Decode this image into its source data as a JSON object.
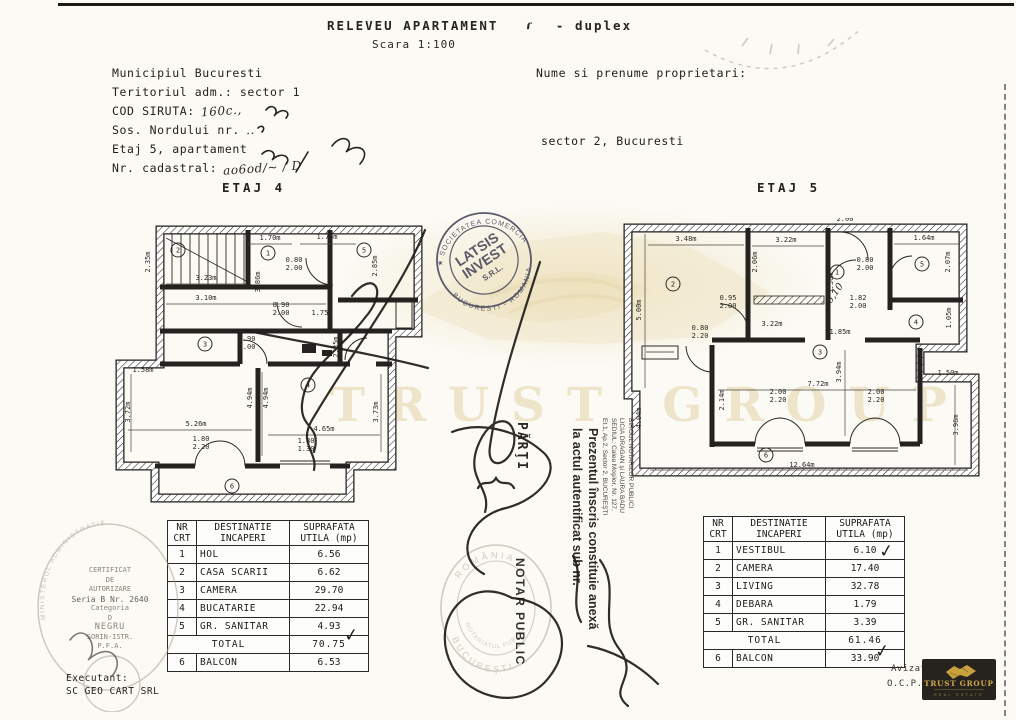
{
  "header": {
    "title": "RELEVEU APARTAMENT",
    "hand_mark": "ɾ",
    "suffix": "- duplex",
    "scale": "Scara 1:100",
    "left_lines": [
      {
        "label": "Municipiul Bucuresti",
        "hand": ""
      },
      {
        "label": "Teritoriul adm.: sector 1",
        "hand": ""
      },
      {
        "label": "COD SIRUTA:",
        "hand": "160c.,"
      },
      {
        "label": "Sos. Nordului nr.",
        "hand": ".."
      },
      {
        "label": "Etaj 5, apartament",
        "hand": ""
      },
      {
        "label": "Nr. cadastral:",
        "hand": "ao6od/~  / D"
      }
    ],
    "owner_label": "Nume si prenume proprietari:",
    "owner_city": "sector 2, Bucuresti"
  },
  "plans": {
    "etaj4": {
      "title": "ETAJ 4",
      "labels": [
        {
          "t": "1.70m",
          "x": 270,
          "y": 240
        },
        {
          "t": "1.76m",
          "x": 327,
          "y": 239
        },
        {
          "t": "2.35m",
          "x": 150,
          "y": 262,
          "r": -90
        },
        {
          "t": "3.23m",
          "x": 206,
          "y": 280
        },
        {
          "t": "3.10m",
          "x": 206,
          "y": 300
        },
        {
          "t": "3.86m",
          "x": 260,
          "y": 282,
          "r": -90
        },
        {
          "t": "0.80",
          "x": 294,
          "y": 262
        },
        {
          "t": "2.00",
          "x": 294,
          "y": 270
        },
        {
          "t": "2.85m",
          "x": 377,
          "y": 266,
          "r": -90
        },
        {
          "t": "1.75m",
          "x": 322,
          "y": 315
        },
        {
          "t": "0.90",
          "x": 281,
          "y": 307
        },
        {
          "t": "2.00",
          "x": 281,
          "y": 315
        },
        {
          "t": "0.90",
          "x": 247,
          "y": 341
        },
        {
          "t": "2.00",
          "x": 247,
          "y": 349
        },
        {
          "t": "2.35m",
          "x": 338,
          "y": 347,
          "r": -90
        },
        {
          "t": "1.58m",
          "x": 143,
          "y": 372
        },
        {
          "t": "5.26m",
          "x": 196,
          "y": 426
        },
        {
          "t": "4.65m",
          "x": 324,
          "y": 431
        },
        {
          "t": "4.94m",
          "x": 252,
          "y": 398,
          "r": -90
        },
        {
          "t": "4.94m",
          "x": 268,
          "y": 398,
          "r": -90
        },
        {
          "t": "3.72m",
          "x": 130,
          "y": 412,
          "r": -90
        },
        {
          "t": "3.73m",
          "x": 378,
          "y": 412,
          "r": -90
        },
        {
          "t": "1.80",
          "x": 201,
          "y": 441
        },
        {
          "t": "2.20",
          "x": 201,
          "y": 449
        },
        {
          "t": "1.80",
          "x": 306,
          "y": 443
        },
        {
          "t": "1.30",
          "x": 306,
          "y": 451
        }
      ],
      "rooms": [
        {
          "n": "2",
          "x": 178,
          "y": 250
        },
        {
          "n": "1",
          "x": 268,
          "y": 253
        },
        {
          "n": "5",
          "x": 364,
          "y": 250
        },
        {
          "n": "3",
          "x": 205,
          "y": 344
        },
        {
          "n": "4",
          "x": 308,
          "y": 385
        },
        {
          "n": "6",
          "x": 232,
          "y": 486
        }
      ]
    },
    "etaj5": {
      "title": "ETAJ 5",
      "hand_note": "6,10",
      "labels": [
        {
          "t": "0.92",
          "x": 845,
          "y": 213
        },
        {
          "t": "2.00",
          "x": 845,
          "y": 221
        },
        {
          "t": "3.48m",
          "x": 686,
          "y": 241
        },
        {
          "t": "3.22m",
          "x": 786,
          "y": 242
        },
        {
          "t": "1.64m",
          "x": 924,
          "y": 240
        },
        {
          "t": "5.00m",
          "x": 641,
          "y": 310,
          "r": -90
        },
        {
          "t": "2.06m",
          "x": 757,
          "y": 262,
          "r": -90
        },
        {
          "t": "3.30m",
          "x": 833,
          "y": 283,
          "r": -90
        },
        {
          "t": "2.07m",
          "x": 950,
          "y": 262,
          "r": -90
        },
        {
          "t": "0.80",
          "x": 865,
          "y": 262
        },
        {
          "t": "2.00",
          "x": 865,
          "y": 270
        },
        {
          "t": "0.95",
          "x": 728,
          "y": 300
        },
        {
          "t": "2.00",
          "x": 728,
          "y": 308
        },
        {
          "t": "1.82",
          "x": 858,
          "y": 300
        },
        {
          "t": "2.00",
          "x": 858,
          "y": 308
        },
        {
          "t": "1.05m",
          "x": 951,
          "y": 318,
          "r": -90
        },
        {
          "t": "3.22m",
          "x": 772,
          "y": 326
        },
        {
          "t": "0.80",
          "x": 700,
          "y": 330
        },
        {
          "t": "2.20",
          "x": 700,
          "y": 338
        },
        {
          "t": "1.85m",
          "x": 840,
          "y": 334
        },
        {
          "t": "7.72m",
          "x": 818,
          "y": 386
        },
        {
          "t": "3.94m",
          "x": 841,
          "y": 372,
          "r": -90
        },
        {
          "t": "2.14m",
          "x": 724,
          "y": 400,
          "r": -90
        },
        {
          "t": "2.00",
          "x": 778,
          "y": 394
        },
        {
          "t": "2.20",
          "x": 778,
          "y": 402
        },
        {
          "t": "2.00",
          "x": 876,
          "y": 394
        },
        {
          "t": "2.20",
          "x": 876,
          "y": 402
        },
        {
          "t": "1.50m",
          "x": 948,
          "y": 375
        },
        {
          "t": "4.04m",
          "x": 641,
          "y": 418,
          "r": -90
        },
        {
          "t": "3.96m",
          "x": 958,
          "y": 425,
          "r": -90
        },
        {
          "t": "12.64m",
          "x": 802,
          "y": 467
        }
      ],
      "rooms": [
        {
          "n": "2",
          "x": 673,
          "y": 284
        },
        {
          "n": "1",
          "x": 837,
          "y": 272
        },
        {
          "n": "5",
          "x": 922,
          "y": 264
        },
        {
          "n": "4",
          "x": 916,
          "y": 322
        },
        {
          "n": "3",
          "x": 820,
          "y": 352
        },
        {
          "n": "6",
          "x": 766,
          "y": 455
        }
      ]
    }
  },
  "tables": {
    "headers": {
      "col1a": "NR",
      "col1b": "CRT",
      "col2a": "DESTINATIE",
      "col2b": "INCAPERI",
      "col3a": "SUPRAFATA",
      "col3b": "UTILA (mp)"
    },
    "etaj4": {
      "rows": [
        [
          "1",
          "HOL",
          "6.56"
        ],
        [
          "2",
          "CASA SCARII",
          "6.62"
        ],
        [
          "3",
          "CAMERA",
          "29.70"
        ],
        [
          "4",
          "BUCATARIE",
          "22.94"
        ],
        [
          "5",
          "GR. SANITAR",
          "4.93"
        ]
      ],
      "total_label": "TOTAL",
      "total": "70.75",
      "balcony": [
        "6",
        "BALCON",
        "6.53"
      ]
    },
    "etaj5": {
      "rows": [
        [
          "1",
          "VESTIBUL",
          "6.10"
        ],
        [
          "2",
          "CAMERA",
          "17.40"
        ],
        [
          "3",
          "LIVING",
          "32.78"
        ],
        [
          "4",
          "DEBARA",
          "1.79"
        ],
        [
          "5",
          "GR. SANITAR",
          "3.39"
        ]
      ],
      "total_label": "TOTAL",
      "total": "61.46",
      "balcony": [
        "6",
        "BALCON",
        "33.90"
      ]
    }
  },
  "stamps": {
    "latsis": {
      "arc_top": "★ SOCIETATEA COMERCIALA ★",
      "arc_bottom": "BUCURESTI - ROMANIA",
      "line1": "LATSIS",
      "line2": "INVEST",
      "line3": "S.R.L."
    },
    "notary_round": {
      "arc_top": "ROMÂNIA",
      "arc_bottom": "BUCUREŞTI",
      "inner": "NOTARIATUL PUBLIC"
    },
    "notar_public_vertical": "NOTAR PUBLIC",
    "parti_vertical": "PĂRŢI",
    "annex_line1": "Prezentul înscris constituie anexă",
    "annex_line2": "la actul autentificat sub nr.",
    "office_lines": [
      "BIROUL NOTARILOR PUBLICI",
      "LICIA DRAGAN şi LAURA BADU",
      "SEDIUL: Calea Moşilor, Nr. 127,",
      "Et.1, Ap.2, Sector 2, BUCUREŞTI"
    ],
    "certificate": {
      "arc": "MINISTERUL ADMINISTRATIEI PUBLICE",
      "lines": [
        "CERTIFICAT",
        "DE",
        "AUTORIZARE",
        "Seria B Nr. 2640",
        "Categoria",
        "D",
        "NEGRU",
        "SORIN-ISTR.",
        "P.F.A."
      ]
    }
  },
  "watermark": {
    "text": "TRUST GROUP"
  },
  "marks": {
    "check": "✓"
  },
  "footer": {
    "executant_label": "Executant:",
    "executant_name": "SC GEO CART SRL",
    "avizat": "Avizat",
    "ocpi": "O.C.P.I",
    "logo": {
      "name": "TRUST GROUP",
      "subtitle": "REAL ESTATE"
    }
  }
}
